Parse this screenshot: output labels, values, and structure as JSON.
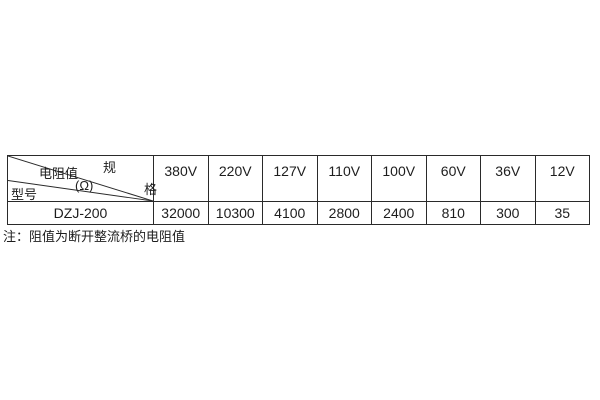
{
  "page": {
    "background": "#ffffff",
    "text_color": "#1d1d1d",
    "border_color": "#2a2a2a"
  },
  "table": {
    "header": {
      "corner": {
        "spec_top": "规",
        "spec_bottom": "格",
        "resistance_label": "电阻值",
        "resistance_unit": "(Ω)",
        "model_label": "型号"
      },
      "columns": [
        "380V",
        "220V",
        "127V",
        "110V",
        "100V",
        "60V",
        "36V",
        "12V"
      ]
    },
    "rows": [
      {
        "model": "DZJ-200",
        "values": [
          "32000",
          "10300",
          "4100",
          "2800",
          "2400",
          "810",
          "300",
          "35"
        ]
      }
    ]
  },
  "note": {
    "text": "注：阻值为断开整流桥的电阻值"
  }
}
